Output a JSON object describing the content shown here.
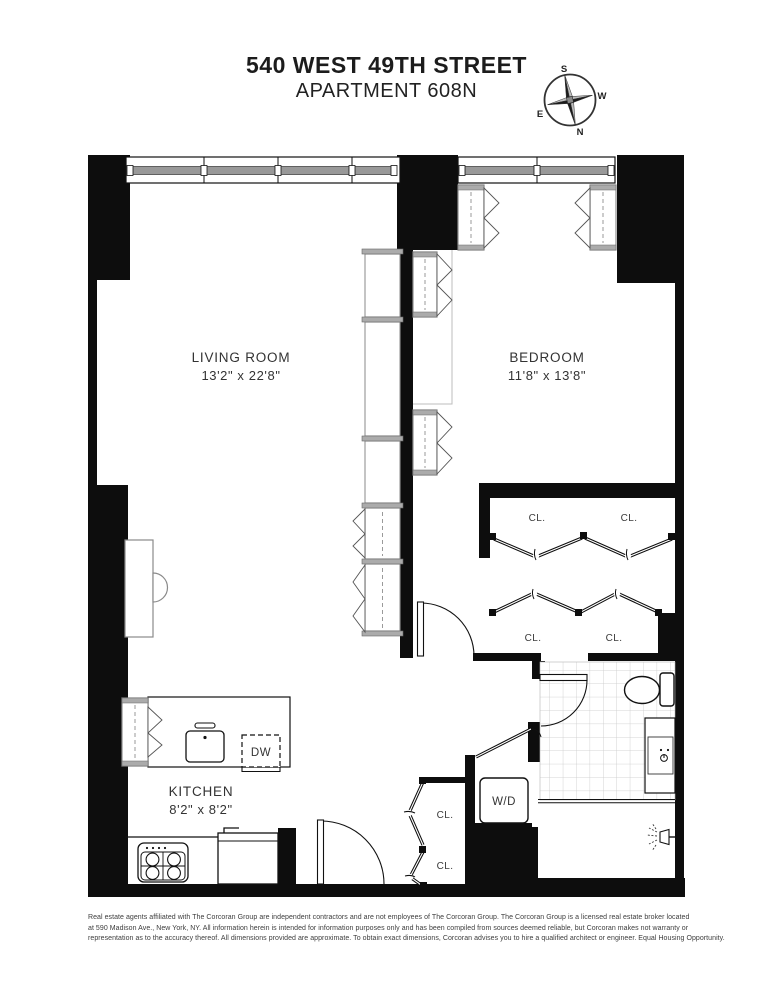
{
  "title": {
    "line1": "540 WEST 49TH STREET",
    "line2": "APARTMENT 608N"
  },
  "compass": {
    "north": "N",
    "south": "S",
    "east": "E",
    "west": "W"
  },
  "floorplan": {
    "rooms": {
      "living_room": {
        "name": "LIVING ROOM",
        "dims": "13'2\" x 22'8\""
      },
      "bedroom": {
        "name": "BEDROOM",
        "dims": "11'8\" x 13'8\""
      },
      "kitchen": {
        "name": "KITCHEN",
        "dims": "8'2\" x 8'2\""
      }
    },
    "labels": {
      "closet": "CL.",
      "dishwasher": "DW",
      "washer_dryer": "W/D"
    }
  },
  "colors": {
    "wall": "#0d0d0d",
    "window_bar": "#999999",
    "unit_border": "#949494",
    "tile_line": "#c9c9c9"
  },
  "disclaimer": {
    "lines": [
      "Real estate agents affiliated with The Corcoran Group are independent contractors and are not employees of The Corcoran Group. The Corcoran Group is a licensed real estate broker located",
      "at 590 Madison Ave., New York, NY. All information herein is intended for information purposes only and has been compiled from sources deemed reliable, but Corcoran makes not warranty or",
      "representation as to the accuracy thereof. All dimensions provided are approximate. To obtain exact dimensions, Corcoran advises you to hire a qualified architect or engineer. Equal Housing Opportunity."
    ]
  }
}
